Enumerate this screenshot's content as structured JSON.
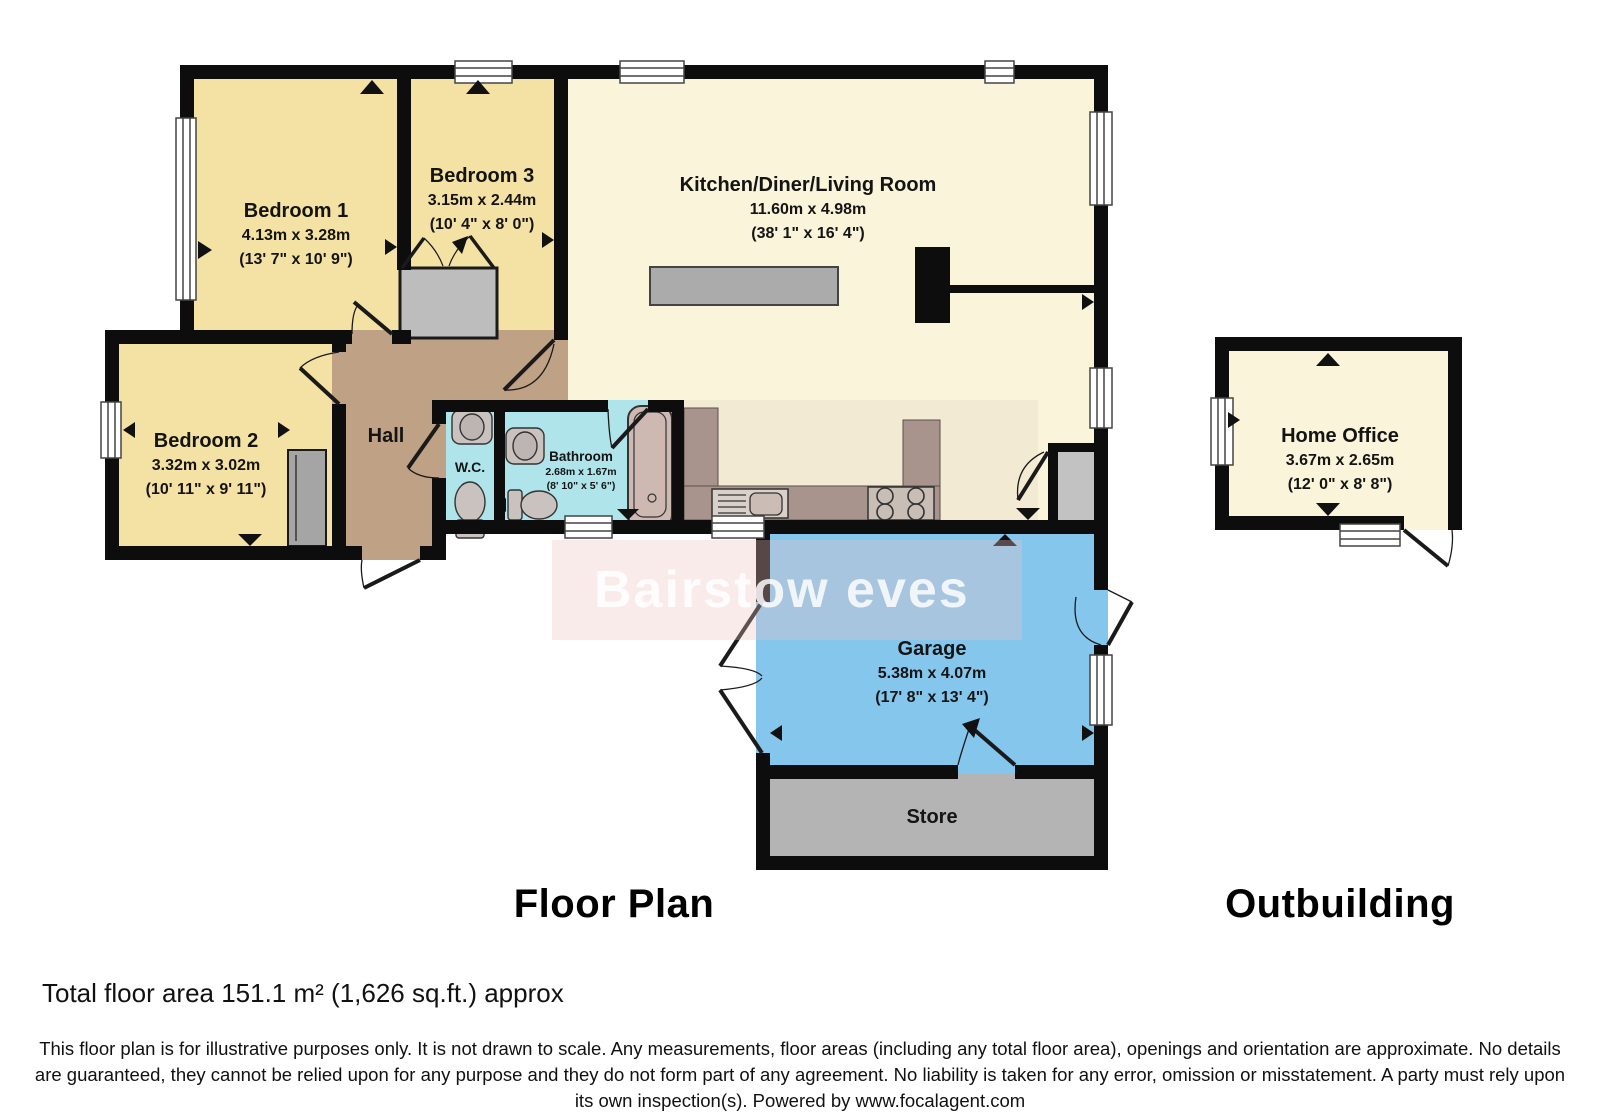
{
  "title": {
    "floor_plan": "Floor Plan",
    "outbuilding": "Outbuilding"
  },
  "rooms": {
    "bedroom1": {
      "name": "Bedroom 1",
      "metric": "4.13m x 3.28m",
      "imperial": "(13' 7\" x 10' 9\")"
    },
    "bedroom2": {
      "name": "Bedroom 2",
      "metric": "3.32m x 3.02m",
      "imperial": "(10' 11\" x 9' 11\")"
    },
    "bedroom3": {
      "name": "Bedroom 3",
      "metric": "3.15m x 2.44m",
      "imperial": "(10' 4\" x 8' 0\")"
    },
    "kitchen": {
      "name": "Kitchen/Diner/Living Room",
      "metric": "11.60m x 4.98m",
      "imperial": "(38' 1\" x 16' 4\")"
    },
    "hall": {
      "name": "Hall"
    },
    "wc": {
      "name": "W.C."
    },
    "bathroom": {
      "name": "Bathroom",
      "metric": "2.68m x 1.67m",
      "imperial": "(8' 10\" x 5' 6\")"
    },
    "garage": {
      "name": "Garage",
      "metric": "5.38m x 4.07m",
      "imperial": "(17' 8\" x 13' 4\")"
    },
    "store": {
      "name": "Store"
    },
    "home_office": {
      "name": "Home Office",
      "metric": "3.67m x 2.65m",
      "imperial": "(12' 0\" x 8' 8\")"
    }
  },
  "watermark": {
    "text": "Bairstow eves"
  },
  "footer": {
    "total_area": "Total floor area 151.1 m² (1,626 sq.ft.) approx",
    "disclaimer": "This floor plan is for illustrative purposes only. It is not drawn to scale. Any measurements, floor areas (including any total floor area), openings and orientation are approximate. No details are guaranteed, they cannot be relied upon for any purpose and they do not form part of any agreement. No liability is taken for any error, omission or misstatement. A party must rely upon its own inspection(s). Powered by www.focalagent.com"
  },
  "colors": {
    "bedroom_fill": "#f4e2a4",
    "kitchen_fill": "#f9f4da",
    "hall_fill": "#bfa285",
    "wet_room_fill": "#aee4ea",
    "garage_fill": "#85c6ed",
    "store_fill": "#b4b4b4",
    "office_fill": "#f9f4da",
    "counter_fill": "#a8948c",
    "wall": "#0d0d0d",
    "watermark_pink": "#f2c1c1"
  }
}
